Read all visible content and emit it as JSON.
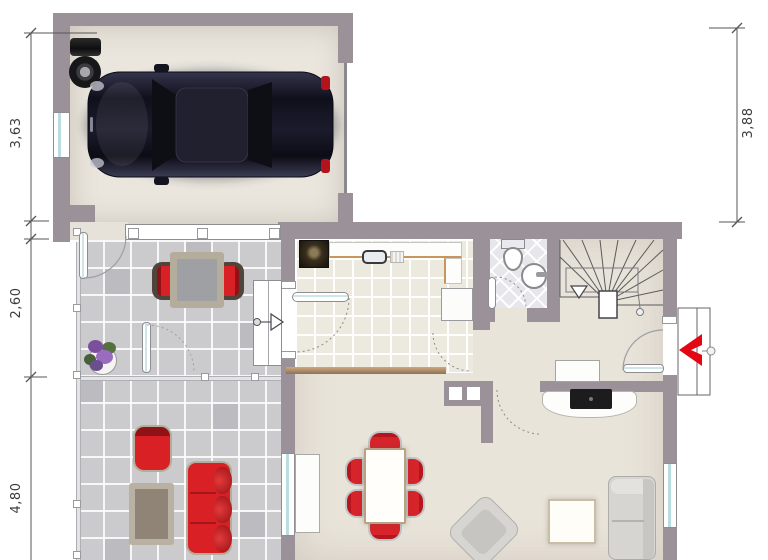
{
  "plan": {
    "type": "ground-floor-plan",
    "dimensions": {
      "left_top": "3,63",
      "left_middle": "2,60",
      "left_bottom": "4,80",
      "right": "3,88"
    },
    "colors": {
      "wall": "#9b9299",
      "garage_floor": "#eae6dd",
      "room_floor": "#e9e4da",
      "kitchen_tile": "#ece9df",
      "terrace_tile": "#cbcbcd",
      "wc_tile": "#e7e7eb",
      "furniture_red": "#d92025",
      "entry_arrow_red": "#e30613",
      "car_body": "#14141f",
      "window_glass": "#bfe0e2",
      "dimension_text": "#3c3c3c"
    },
    "icons": [
      "car",
      "spare-tires",
      "stairs",
      "toilet",
      "washbasin",
      "stove",
      "sink",
      "entrance-arrow",
      "plant",
      "sofa",
      "dining-set",
      "tv-sideboard"
    ]
  }
}
